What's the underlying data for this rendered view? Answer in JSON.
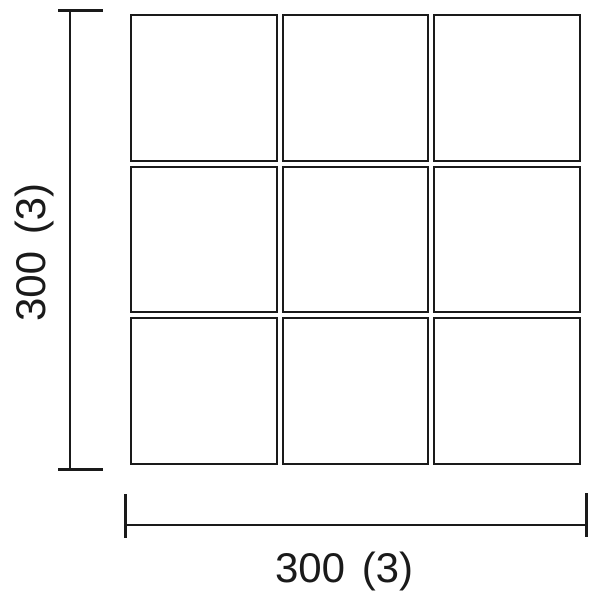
{
  "diagram": {
    "background_color": "#ffffff",
    "line_color": "#1a1a1a",
    "grid": {
      "rows": 3,
      "cols": 3
    },
    "vertical_dimension": {
      "label": "300 (3)"
    },
    "horizontal_dimension": {
      "label": "300 (3)"
    }
  }
}
